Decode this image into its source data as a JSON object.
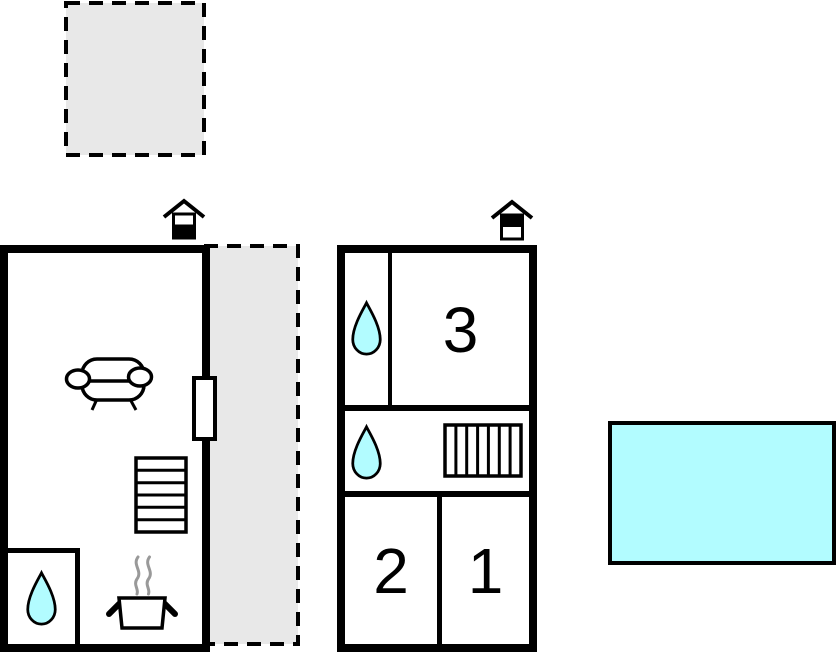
{
  "colors": {
    "wall": "#000000",
    "water_fill": "#b2fcff",
    "terrace_fill": "#e8e8e8",
    "steam": "#999999",
    "background": "#ffffff",
    "room_fill": "#ffffff"
  },
  "rooms": {
    "room1": {
      "label": "1"
    },
    "room2": {
      "label": "2"
    },
    "room3": {
      "label": "3"
    }
  },
  "elements": {
    "terrace_upper": "dashed outdoor area",
    "terrace_side": "dashed outdoor area",
    "pool": "water area",
    "icons": [
      "chimney-icon",
      "sofa-icon",
      "staircase-horizontal-icon",
      "staircase-vertical-icon",
      "water-drop-icon",
      "stove-icon",
      "door-window"
    ]
  }
}
